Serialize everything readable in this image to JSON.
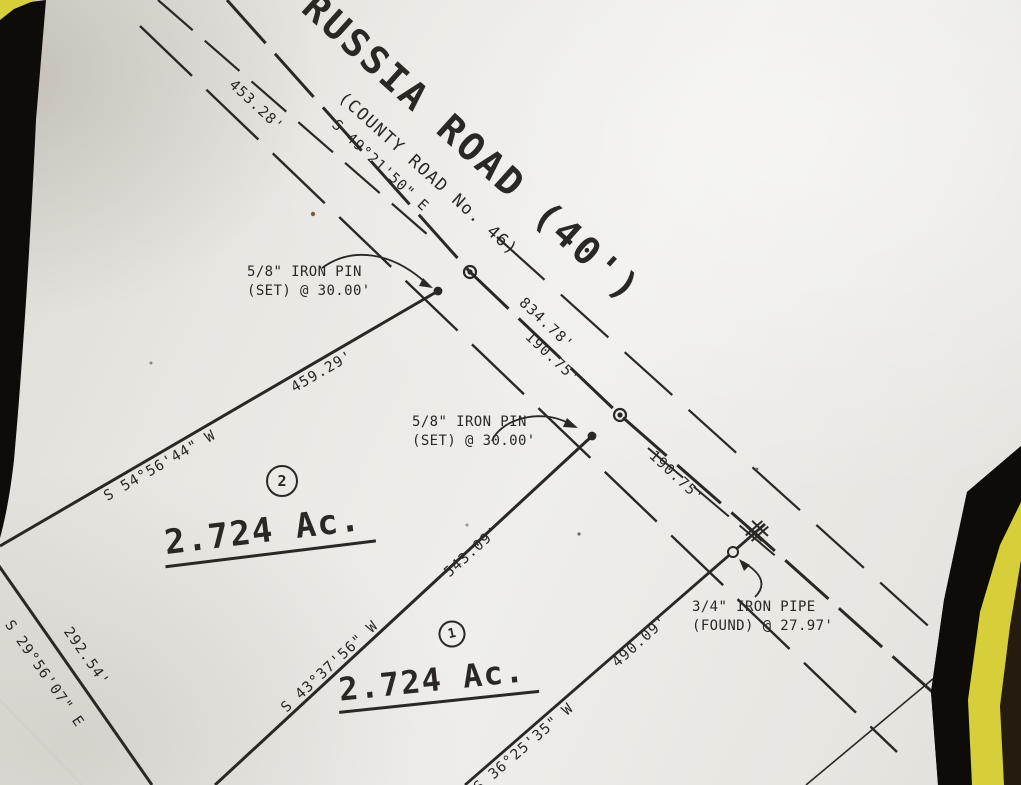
{
  "photo": {
    "paper_color": "#eae7e2",
    "ink_color": "#2b2824",
    "frame_black": "#0e0c09",
    "frame_yellow": "#d6cf39",
    "backdrop_brown": "#261b0f"
  },
  "road": {
    "name": "RUSSIA ROAD (40')",
    "subtitle": "(COUNTY ROAD No. 46)",
    "centerline_bearing": "S 49°21'50\" E",
    "dims": {
      "d453_28": "453.28'",
      "d834_78": "834.78'",
      "d190_75_upper": "190.75'",
      "d190_75_lower": "190.75'"
    }
  },
  "lots": {
    "lot2": {
      "number": "2",
      "area": "2.724 Ac.",
      "bearing_north": "S 54°56'44\" W",
      "dim_north": "459.29'",
      "bearing_west": "S 29°56'07\" E",
      "dim_west": "292.54'"
    },
    "lot1": {
      "number": "1",
      "area": "2.724 Ac.",
      "bearing_middle": "S 43°37'56\" W",
      "dim_middle": "543.09'",
      "bearing_south": "S 36°25'35\" W",
      "dim_south": "490.09'"
    }
  },
  "monuments": {
    "pin_top": {
      "line1": "5/8\" IRON PIN",
      "line2": "(SET) @ 30.00'"
    },
    "pin_mid": {
      "line1": "5/8\" IRON PIN",
      "line2": "(SET) @ 30.00'"
    },
    "pipe": {
      "line1": "3/4\" IRON PIPE",
      "line2": "(FOUND) @ 27.97'"
    }
  }
}
